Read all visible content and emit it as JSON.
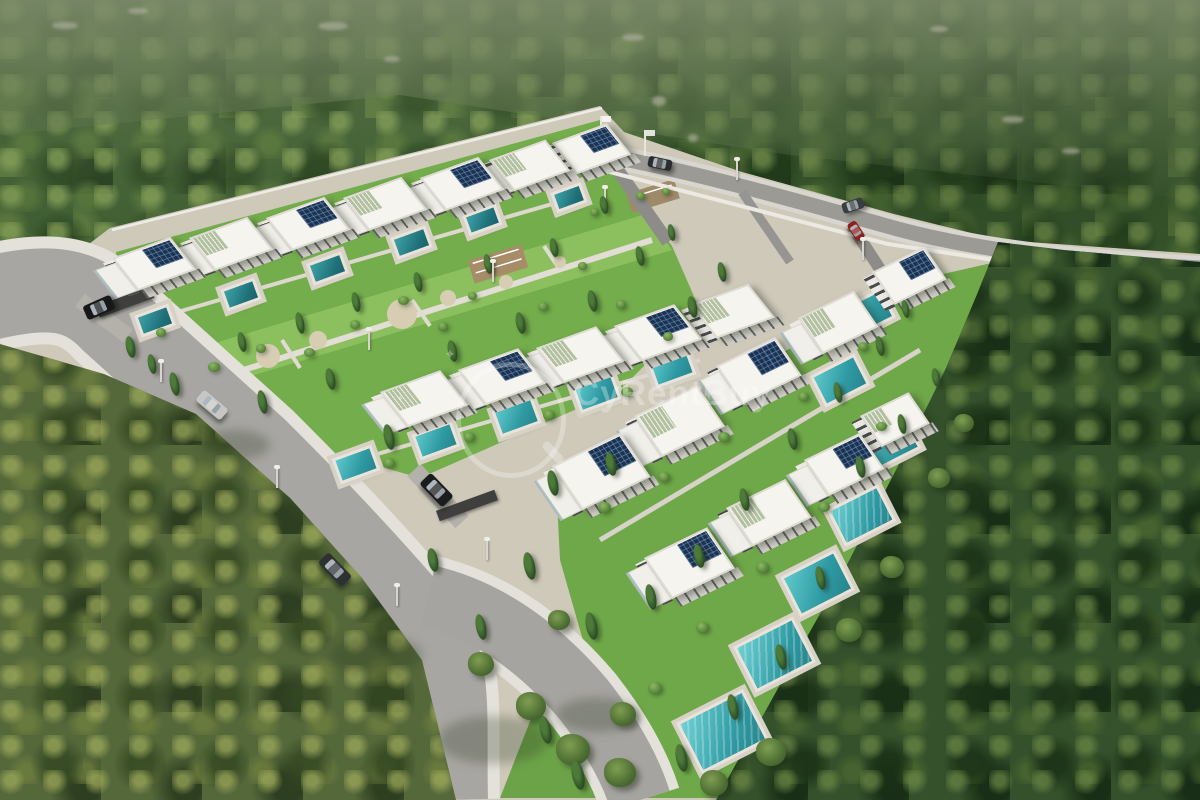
{
  "meta": {
    "title": "Aerial 3D render of a gated villa development surrounded by forest",
    "width": 1200,
    "height": 800
  },
  "watermark": {
    "text": "CyRentBuy",
    "color": "#ffffff",
    "opacity": 0.3,
    "logo": "magnifier-icon"
  },
  "palette": {
    "forest_dark": "#2b4a23",
    "forest_mid": "#3b5a2f",
    "forest_light": "#85a056",
    "olive_forest": "#55683a",
    "hill_haze": "#7e8c68",
    "villa_white": "#f6f4ef",
    "villa_shadow": "#d2cfc8",
    "wood_accent": "#c1a06a",
    "solar_panel": "#1c3350",
    "glass": "#a9c4c8",
    "lawn": "#74ad4c",
    "park_lawn": "#8cc05e",
    "sand": "#d6cdb2",
    "road": "#a8a6a2",
    "sidewalk": "#e4e1db",
    "alley": "#8e8c88",
    "wall": "#ece9e2",
    "pool_bright": "#5ec8cb",
    "pool_dark": "#27858d",
    "car_black": "#16181a",
    "car_silver": "#c6c6c4",
    "car_red": "#8e1f1f",
    "car_gray": "#2e3134"
  },
  "scene": {
    "villas": [
      {
        "x": 112,
        "y": 258,
        "w": 62,
        "h": 42,
        "solar": 1,
        "step": 1,
        "pergola": 0,
        "steep": 0
      },
      {
        "x": 189,
        "y": 238,
        "w": 62,
        "h": 42,
        "solar": 0,
        "step": 1,
        "pergola": 1,
        "steep": 0
      },
      {
        "x": 266,
        "y": 218,
        "w": 62,
        "h": 42,
        "solar": 1,
        "step": 1,
        "pergola": 0,
        "steep": 0
      },
      {
        "x": 343,
        "y": 198,
        "w": 62,
        "h": 42,
        "solar": 0,
        "step": 1,
        "pergola": 1,
        "steep": 0
      },
      {
        "x": 420,
        "y": 178,
        "w": 62,
        "h": 42,
        "solar": 1,
        "step": 1,
        "pergola": 0,
        "steep": 0
      },
      {
        "x": 489,
        "y": 160,
        "w": 60,
        "h": 40,
        "solar": 0,
        "step": 1,
        "pergola": 1,
        "steep": 0
      },
      {
        "x": 552,
        "y": 143,
        "w": 58,
        "h": 40,
        "solar": 1,
        "step": 0,
        "pergola": 0,
        "steep": 0
      },
      {
        "x": 380,
        "y": 392,
        "w": 64,
        "h": 45,
        "solar": 0,
        "step": 1,
        "pergola": 1,
        "steep": 0
      },
      {
        "x": 458,
        "y": 370,
        "w": 64,
        "h": 45,
        "solar": 1,
        "step": 1,
        "pergola": 0,
        "steep": 0
      },
      {
        "x": 536,
        "y": 348,
        "w": 64,
        "h": 45,
        "solar": 0,
        "step": 1,
        "pergola": 1,
        "steep": 0
      },
      {
        "x": 614,
        "y": 326,
        "w": 64,
        "h": 45,
        "solar": 1,
        "step": 1,
        "pergola": 0,
        "steep": 0
      },
      {
        "x": 690,
        "y": 305,
        "w": 62,
        "h": 43,
        "solar": 0,
        "step": 0,
        "pergola": 1,
        "steep": 0
      },
      {
        "x": 552,
        "y": 466,
        "w": 76,
        "h": 54,
        "solar": 1,
        "step": 1,
        "pergola": 0,
        "steep": 1
      },
      {
        "x": 634,
        "y": 416,
        "w": 70,
        "h": 50,
        "solar": 0,
        "step": 1,
        "pergola": 1,
        "steep": 1
      },
      {
        "x": 716,
        "y": 366,
        "w": 66,
        "h": 47,
        "solar": 1,
        "step": 1,
        "pergola": 0,
        "steep": 1
      },
      {
        "x": 798,
        "y": 318,
        "w": 62,
        "h": 44,
        "solar": 0,
        "step": 1,
        "pergola": 1,
        "steep": 1
      },
      {
        "x": 872,
        "y": 272,
        "w": 58,
        "h": 40,
        "solar": 1,
        "step": 0,
        "pergola": 0,
        "steep": 1
      },
      {
        "x": 644,
        "y": 558,
        "w": 70,
        "h": 50,
        "solar": 1,
        "step": 1,
        "pergola": 0,
        "steep": 1
      },
      {
        "x": 726,
        "y": 508,
        "w": 66,
        "h": 47,
        "solar": 0,
        "step": 1,
        "pergola": 1,
        "steep": 1
      },
      {
        "x": 804,
        "y": 460,
        "w": 62,
        "h": 44,
        "solar": 1,
        "step": 1,
        "pergola": 0,
        "steep": 1
      },
      {
        "x": 860,
        "y": 416,
        "w": 54,
        "h": 38,
        "solar": 0,
        "step": 0,
        "pergola": 1,
        "steep": 1
      }
    ],
    "pools": [
      {
        "x": 140,
        "y": 312,
        "w": 30,
        "h": 17,
        "type": "dark"
      },
      {
        "x": 226,
        "y": 286,
        "w": 30,
        "h": 17,
        "type": "dark"
      },
      {
        "x": 312,
        "y": 260,
        "w": 31,
        "h": 17,
        "type": "dark"
      },
      {
        "x": 396,
        "y": 234,
        "w": 31,
        "h": 17,
        "type": "dark"
      },
      {
        "x": 468,
        "y": 212,
        "w": 29,
        "h": 16,
        "type": "dark"
      },
      {
        "x": 556,
        "y": 190,
        "w": 26,
        "h": 15,
        "type": "dark"
      },
      {
        "x": 338,
        "y": 454,
        "w": 36,
        "h": 21,
        "type": ""
      },
      {
        "x": 418,
        "y": 430,
        "w": 36,
        "h": 21,
        "type": ""
      },
      {
        "x": 498,
        "y": 406,
        "w": 37,
        "h": 22,
        "type": ""
      },
      {
        "x": 578,
        "y": 382,
        "w": 37,
        "h": 22,
        "type": ""
      },
      {
        "x": 654,
        "y": 358,
        "w": 36,
        "h": 21,
        "type": ""
      },
      {
        "x": 846,
        "y": 300,
        "w": 42,
        "h": 27,
        "type": "steep"
      },
      {
        "x": 818,
        "y": 366,
        "w": 44,
        "h": 29,
        "type": "steep"
      },
      {
        "x": 866,
        "y": 428,
        "w": 47,
        "h": 31,
        "type": "steep"
      },
      {
        "x": 836,
        "y": 498,
        "w": 51,
        "h": 35,
        "type": "lanes steep"
      },
      {
        "x": 790,
        "y": 564,
        "w": 55,
        "h": 39,
        "type": "steep"
      },
      {
        "x": 744,
        "y": 632,
        "w": 61,
        "h": 45,
        "type": "lanes steep"
      },
      {
        "x": 688,
        "y": 706,
        "w": 69,
        "h": 51,
        "type": "lanes steep"
      }
    ],
    "cypresses": [
      [
        126,
        336,
        9,
        22
      ],
      [
        148,
        354,
        8,
        20
      ],
      [
        170,
        372,
        9,
        24
      ],
      [
        238,
        332,
        8,
        20
      ],
      [
        258,
        390,
        9,
        24
      ],
      [
        296,
        312,
        8,
        22
      ],
      [
        326,
        368,
        9,
        22
      ],
      [
        352,
        292,
        8,
        20
      ],
      [
        384,
        424,
        10,
        26
      ],
      [
        414,
        272,
        8,
        20
      ],
      [
        448,
        340,
        9,
        22
      ],
      [
        484,
        254,
        8,
        20
      ],
      [
        516,
        312,
        9,
        22
      ],
      [
        550,
        238,
        8,
        19
      ],
      [
        588,
        290,
        9,
        22
      ],
      [
        600,
        196,
        8,
        18
      ],
      [
        636,
        246,
        8,
        20
      ],
      [
        668,
        224,
        7,
        17
      ],
      [
        688,
        296,
        9,
        22
      ],
      [
        718,
        262,
        8,
        20
      ],
      [
        548,
        470,
        10,
        26
      ],
      [
        524,
        552,
        11,
        28
      ],
      [
        606,
        452,
        10,
        24
      ],
      [
        586,
        612,
        11,
        28
      ],
      [
        646,
        584,
        10,
        26
      ],
      [
        694,
        544,
        10,
        24
      ],
      [
        740,
        488,
        9,
        23
      ],
      [
        788,
        428,
        9,
        22
      ],
      [
        834,
        382,
        8,
        21
      ],
      [
        876,
        336,
        8,
        20
      ],
      [
        902,
        300,
        7,
        18
      ],
      [
        856,
        456,
        9,
        22
      ],
      [
        898,
        414,
        8,
        20
      ],
      [
        932,
        368,
        8,
        19
      ],
      [
        816,
        566,
        9,
        24
      ],
      [
        776,
        644,
        10,
        26
      ],
      [
        728,
        694,
        10,
        26
      ],
      [
        676,
        744,
        11,
        28
      ],
      [
        476,
        614,
        10,
        26
      ],
      [
        428,
        548,
        10,
        24
      ],
      [
        540,
        716,
        11,
        28
      ],
      [
        572,
        760,
        12,
        30
      ]
    ],
    "bushes": [
      [
        156,
        328,
        10
      ],
      [
        208,
        362,
        12
      ],
      [
        256,
        344,
        10
      ],
      [
        304,
        348,
        11
      ],
      [
        350,
        320,
        10
      ],
      [
        398,
        296,
        11
      ],
      [
        438,
        322,
        10
      ],
      [
        468,
        292,
        9
      ],
      [
        538,
        302,
        10
      ],
      [
        578,
        262,
        9
      ],
      [
        616,
        300,
        10
      ],
      [
        383,
        458,
        12
      ],
      [
        463,
        432,
        12
      ],
      [
        543,
        410,
        12
      ],
      [
        621,
        387,
        12
      ],
      [
        663,
        332,
        10
      ],
      [
        598,
        502,
        13
      ],
      [
        658,
        472,
        12
      ],
      [
        718,
        432,
        12
      ],
      [
        798,
        392,
        11
      ],
      [
        858,
        342,
        10
      ],
      [
        756,
        562,
        13
      ],
      [
        818,
        502,
        12
      ],
      [
        876,
        422,
        11
      ],
      [
        696,
        622,
        13
      ],
      [
        648,
        682,
        14
      ],
      [
        906,
        262,
        9
      ],
      [
        636,
        192,
        9
      ],
      [
        662,
        188,
        8
      ],
      [
        590,
        208,
        9
      ]
    ],
    "trees": [
      [
        516,
        692,
        30
      ],
      [
        556,
        734,
        34
      ],
      [
        468,
        652,
        26
      ],
      [
        604,
        758,
        32
      ],
      [
        756,
        738,
        30
      ],
      [
        836,
        618,
        26
      ],
      [
        880,
        556,
        24
      ],
      [
        928,
        468,
        22
      ],
      [
        954,
        414,
        20
      ],
      [
        610,
        702,
        26
      ],
      [
        700,
        770,
        28
      ],
      [
        548,
        610,
        22
      ]
    ],
    "cars": [
      {
        "x": 84,
        "y": 300,
        "w": 30,
        "h": 15,
        "rot": -24,
        "color": "#16181a",
        "kind": "black-suv"
      },
      {
        "x": 196,
        "y": 398,
        "w": 32,
        "h": 14,
        "rot": 40,
        "color": "#c6c6c4",
        "kind": "silver-coupe"
      },
      {
        "x": 318,
        "y": 562,
        "w": 34,
        "h": 15,
        "rot": 46,
        "color": "#2e3134",
        "kind": "dark-gray-car"
      },
      {
        "x": 420,
        "y": 482,
        "w": 33,
        "h": 16,
        "rot": 46,
        "color": "#1a1c1e",
        "kind": "black-suv-parked"
      },
      {
        "x": 648,
        "y": 158,
        "w": 24,
        "h": 11,
        "rot": 12,
        "color": "#2a2d30",
        "kind": "dark-car"
      },
      {
        "x": 842,
        "y": 200,
        "w": 22,
        "h": 11,
        "rot": -18,
        "color": "#3a3d40",
        "kind": "dark-car-parked"
      },
      {
        "x": 846,
        "y": 226,
        "w": 20,
        "h": 10,
        "rot": 58,
        "color": "#8e1f1f",
        "kind": "red-car"
      }
    ],
    "fences": [
      [
        96,
        296,
        58,
        12
      ],
      [
        436,
        500,
        62,
        11
      ]
    ],
    "shadows": [
      [
        330,
        636,
        92,
        38
      ],
      [
        438,
        716,
        110,
        48
      ],
      [
        556,
        698,
        82,
        34
      ],
      [
        200,
        430,
        70,
        30
      ]
    ],
    "lamps": [
      [
        160,
        362
      ],
      [
        276,
        468
      ],
      [
        396,
        586
      ],
      [
        486,
        540
      ],
      [
        604,
        188
      ],
      [
        736,
        160
      ],
      [
        862,
        240
      ],
      [
        368,
        330
      ],
      [
        492,
        262
      ]
    ],
    "flags": [
      [
        600,
        116
      ],
      [
        644,
        130
      ]
    ],
    "rocks": [
      [
        52,
        22,
        26,
        7
      ],
      [
        128,
        8,
        20,
        6
      ],
      [
        318,
        22,
        30,
        8
      ],
      [
        384,
        56,
        16,
        6
      ],
      [
        622,
        34,
        22,
        7
      ],
      [
        652,
        96,
        14,
        10
      ],
      [
        688,
        134,
        10,
        8
      ],
      [
        930,
        26,
        18,
        6
      ],
      [
        1002,
        116,
        22,
        7
      ],
      [
        1062,
        148,
        18,
        6
      ],
      [
        160,
        640,
        16,
        8
      ],
      [
        232,
        700,
        20,
        9
      ],
      [
        96,
        556,
        14,
        7
      ]
    ]
  }
}
